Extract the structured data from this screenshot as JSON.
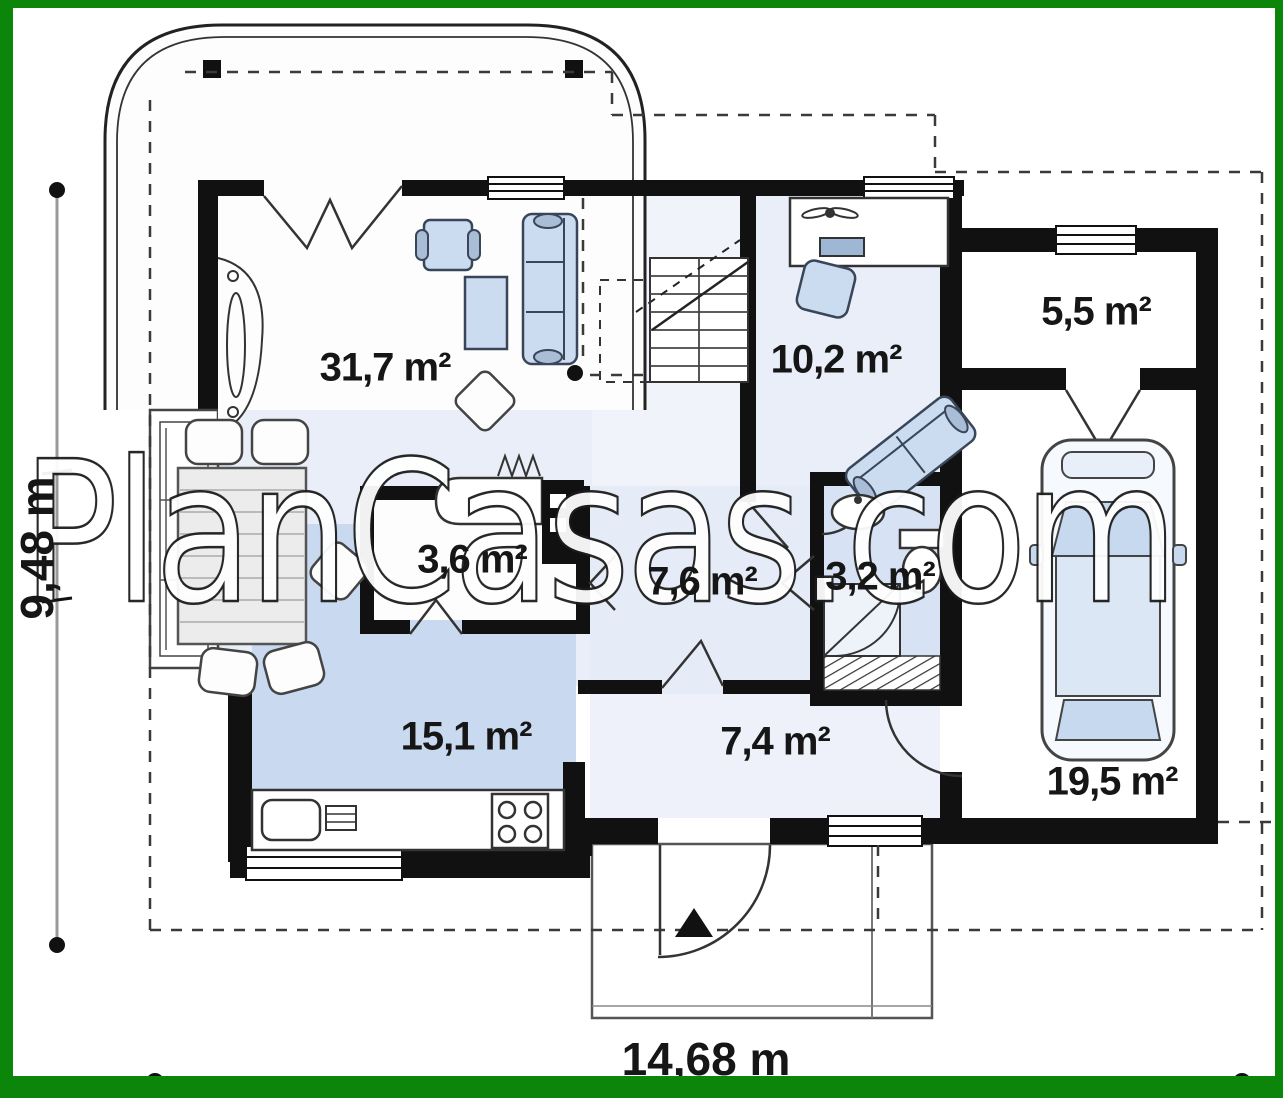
{
  "watermark": "PlanCasas.com",
  "dimensions": {
    "height_label": "9,48 m",
    "width_label": "14,68 m"
  },
  "rooms": {
    "living_room": {
      "area": "31,7 m²"
    },
    "office": {
      "area": "10,2 m²"
    },
    "storage": {
      "area": "5,5 m²"
    },
    "pantry": {
      "area": "3,6 m²"
    },
    "hall": {
      "area": "7,6 m²"
    },
    "bathroom": {
      "area": "3,2 m²"
    },
    "kitchen": {
      "area": "15,1 m²"
    },
    "entry": {
      "area": "7,4 m²"
    },
    "garage": {
      "area": "19,5 m²"
    }
  },
  "colors": {
    "frame_green": "#0b860b",
    "wall_black": "#111111",
    "floor_light_blue": "#e9eef8",
    "floor_kitchen_blue": "#c9daf0",
    "floor_bath_blue": "#d7e3f4",
    "furniture_blue": "#ccdcf0"
  }
}
